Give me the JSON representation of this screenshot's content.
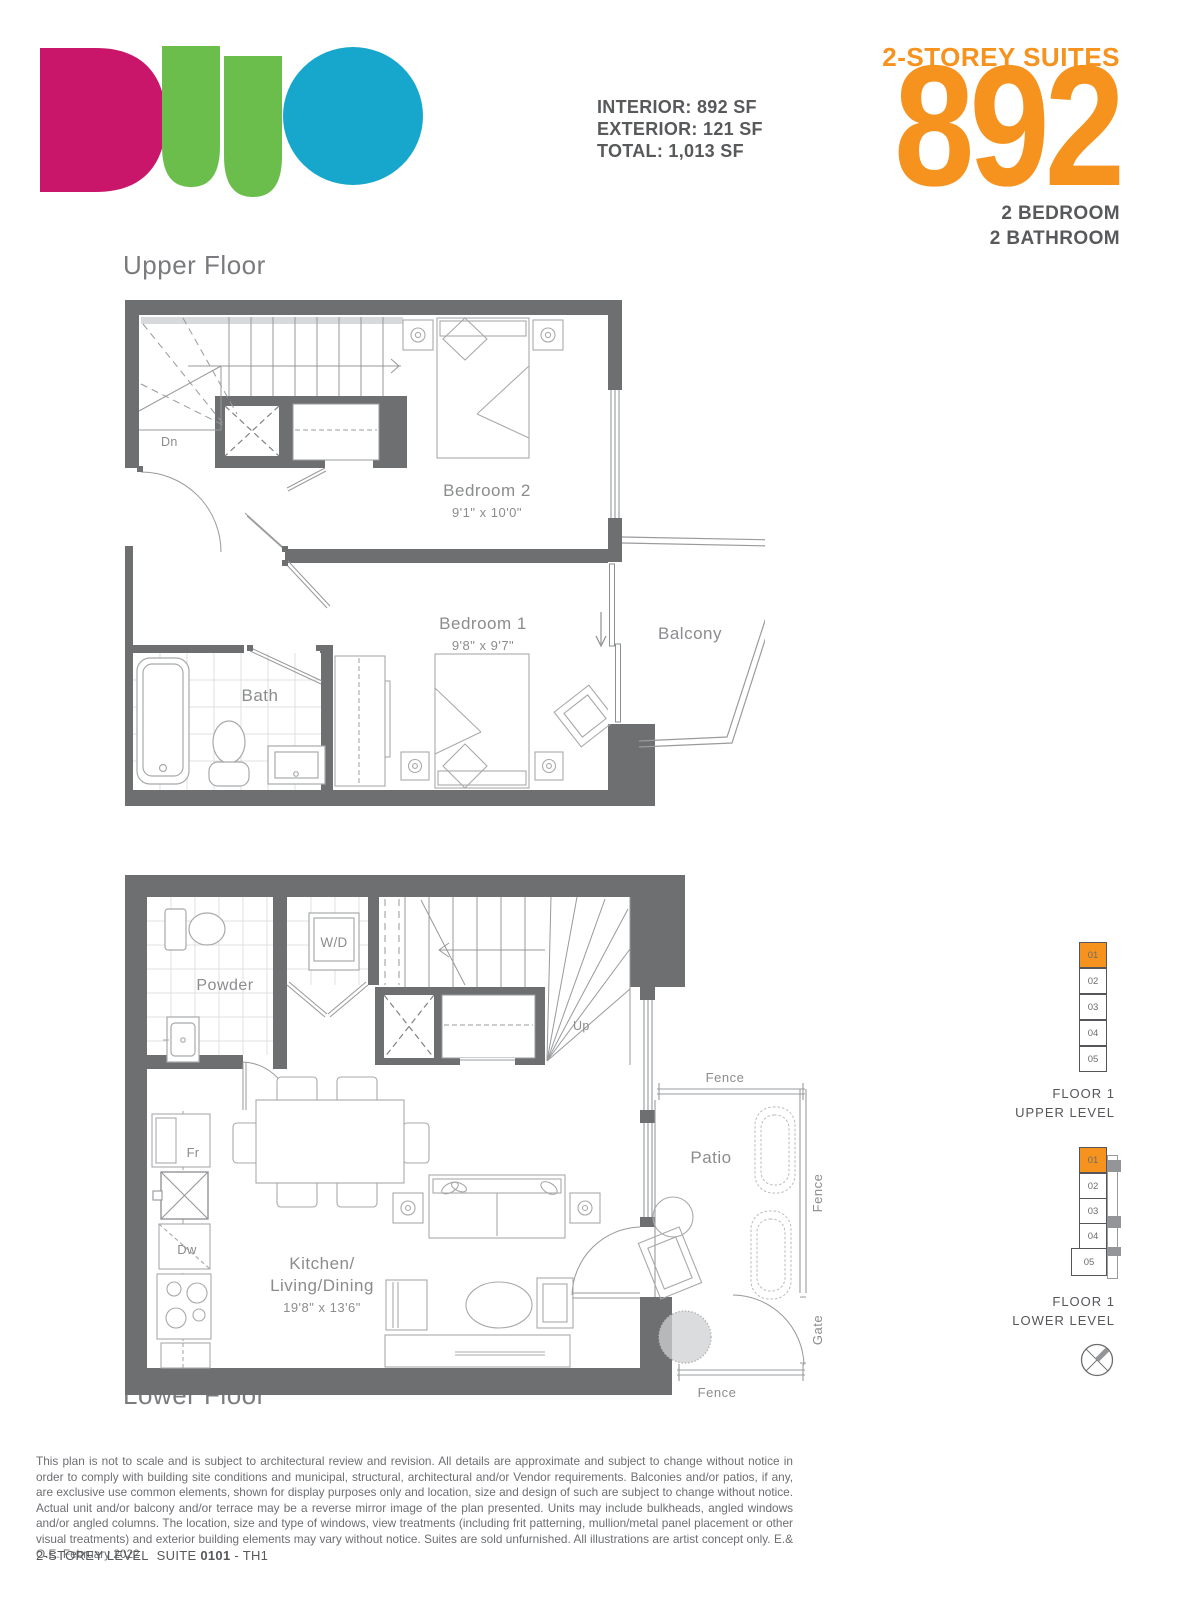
{
  "brand": "DUO",
  "header": {
    "stats": [
      "INTERIOR: 892 SF",
      "EXTERIOR: 121 SF",
      "TOTAL: 1,013 SF"
    ],
    "suite_category": "2-STOREY SUITES",
    "suite_sf": "892",
    "bed_bath": [
      "2 BEDROOM",
      "2 BATHROOM"
    ]
  },
  "upper_floor": {
    "title": "Upper Floor",
    "labels": {
      "bedroom2": "Bedroom 2",
      "bedroom2_dims": "9'1\" x 10'0\"",
      "bedroom1": "Bedroom 1",
      "bedroom1_dims": "9'8\" x 9'7\"",
      "bath": "Bath",
      "balcony": "Balcony",
      "stairs_dn": "Dn"
    }
  },
  "lower_floor": {
    "title": "Lower Floor",
    "labels": {
      "kitchen_line1": "Kitchen/",
      "kitchen_line2": "Living/Dining",
      "kitchen_dims": "19'8\" x 13'6\"",
      "powder": "Powder",
      "washer_dryer": "W/D",
      "stairs_up": "Up",
      "fridge": "Fr",
      "dishwasher": "Dw",
      "patio": "Patio",
      "fence_top": "Fence",
      "fence_right": "Fence",
      "fence_bottom": "Fence",
      "gate": "Gate"
    }
  },
  "keyplans": {
    "upper": {
      "line1": "FLOOR 1",
      "line2": "UPPER LEVEL",
      "units": [
        "01",
        "02",
        "03",
        "04",
        "05"
      ],
      "highlighted_unit": "01"
    },
    "lower": {
      "line1": "FLOOR 1",
      "line2": "LOWER LEVEL",
      "units": [
        "01",
        "02",
        "03",
        "04",
        "05"
      ],
      "highlighted_unit": "01"
    }
  },
  "footer": {
    "disclaimer": "This plan is not to scale and is subject to architectural review and revision. All details are approximate and subject to change without notice in order to comply with building site conditions and municipal, structural, architectural and/or Vendor requirements. Balconies and/or patios, if any, are exclusive use common elements, shown for display purposes only and location, size and design of such are subject to change without notice. Actual unit and/or balcony and/or terrace may be a reverse mirror image of the plan presented. Units may include bulkheads, angled windows and/or angled columns. The location, size and type of windows, view treatments (including frit patterning, mullion/metal panel placement or other visual treatments) and exterior building elements may vary without notice. Suites are sold unfurnished. All illustrations are artist concept only. E.& O.E. February 2022",
    "suite_prefix": "2-STOREY LEVEL",
    "suite_word": "SUITE",
    "suite_number": "0101",
    "suite_suffix": "- TH1"
  },
  "colors": {
    "accent_orange": "#F6921E",
    "wall_gray": "#6E6F71",
    "heading_gray": "#58595B",
    "plan_text_gray": "#8B8C8E",
    "logo_pink": "#C9166B",
    "logo_green": "#6CBE4C",
    "logo_blue": "#17A7CD"
  }
}
